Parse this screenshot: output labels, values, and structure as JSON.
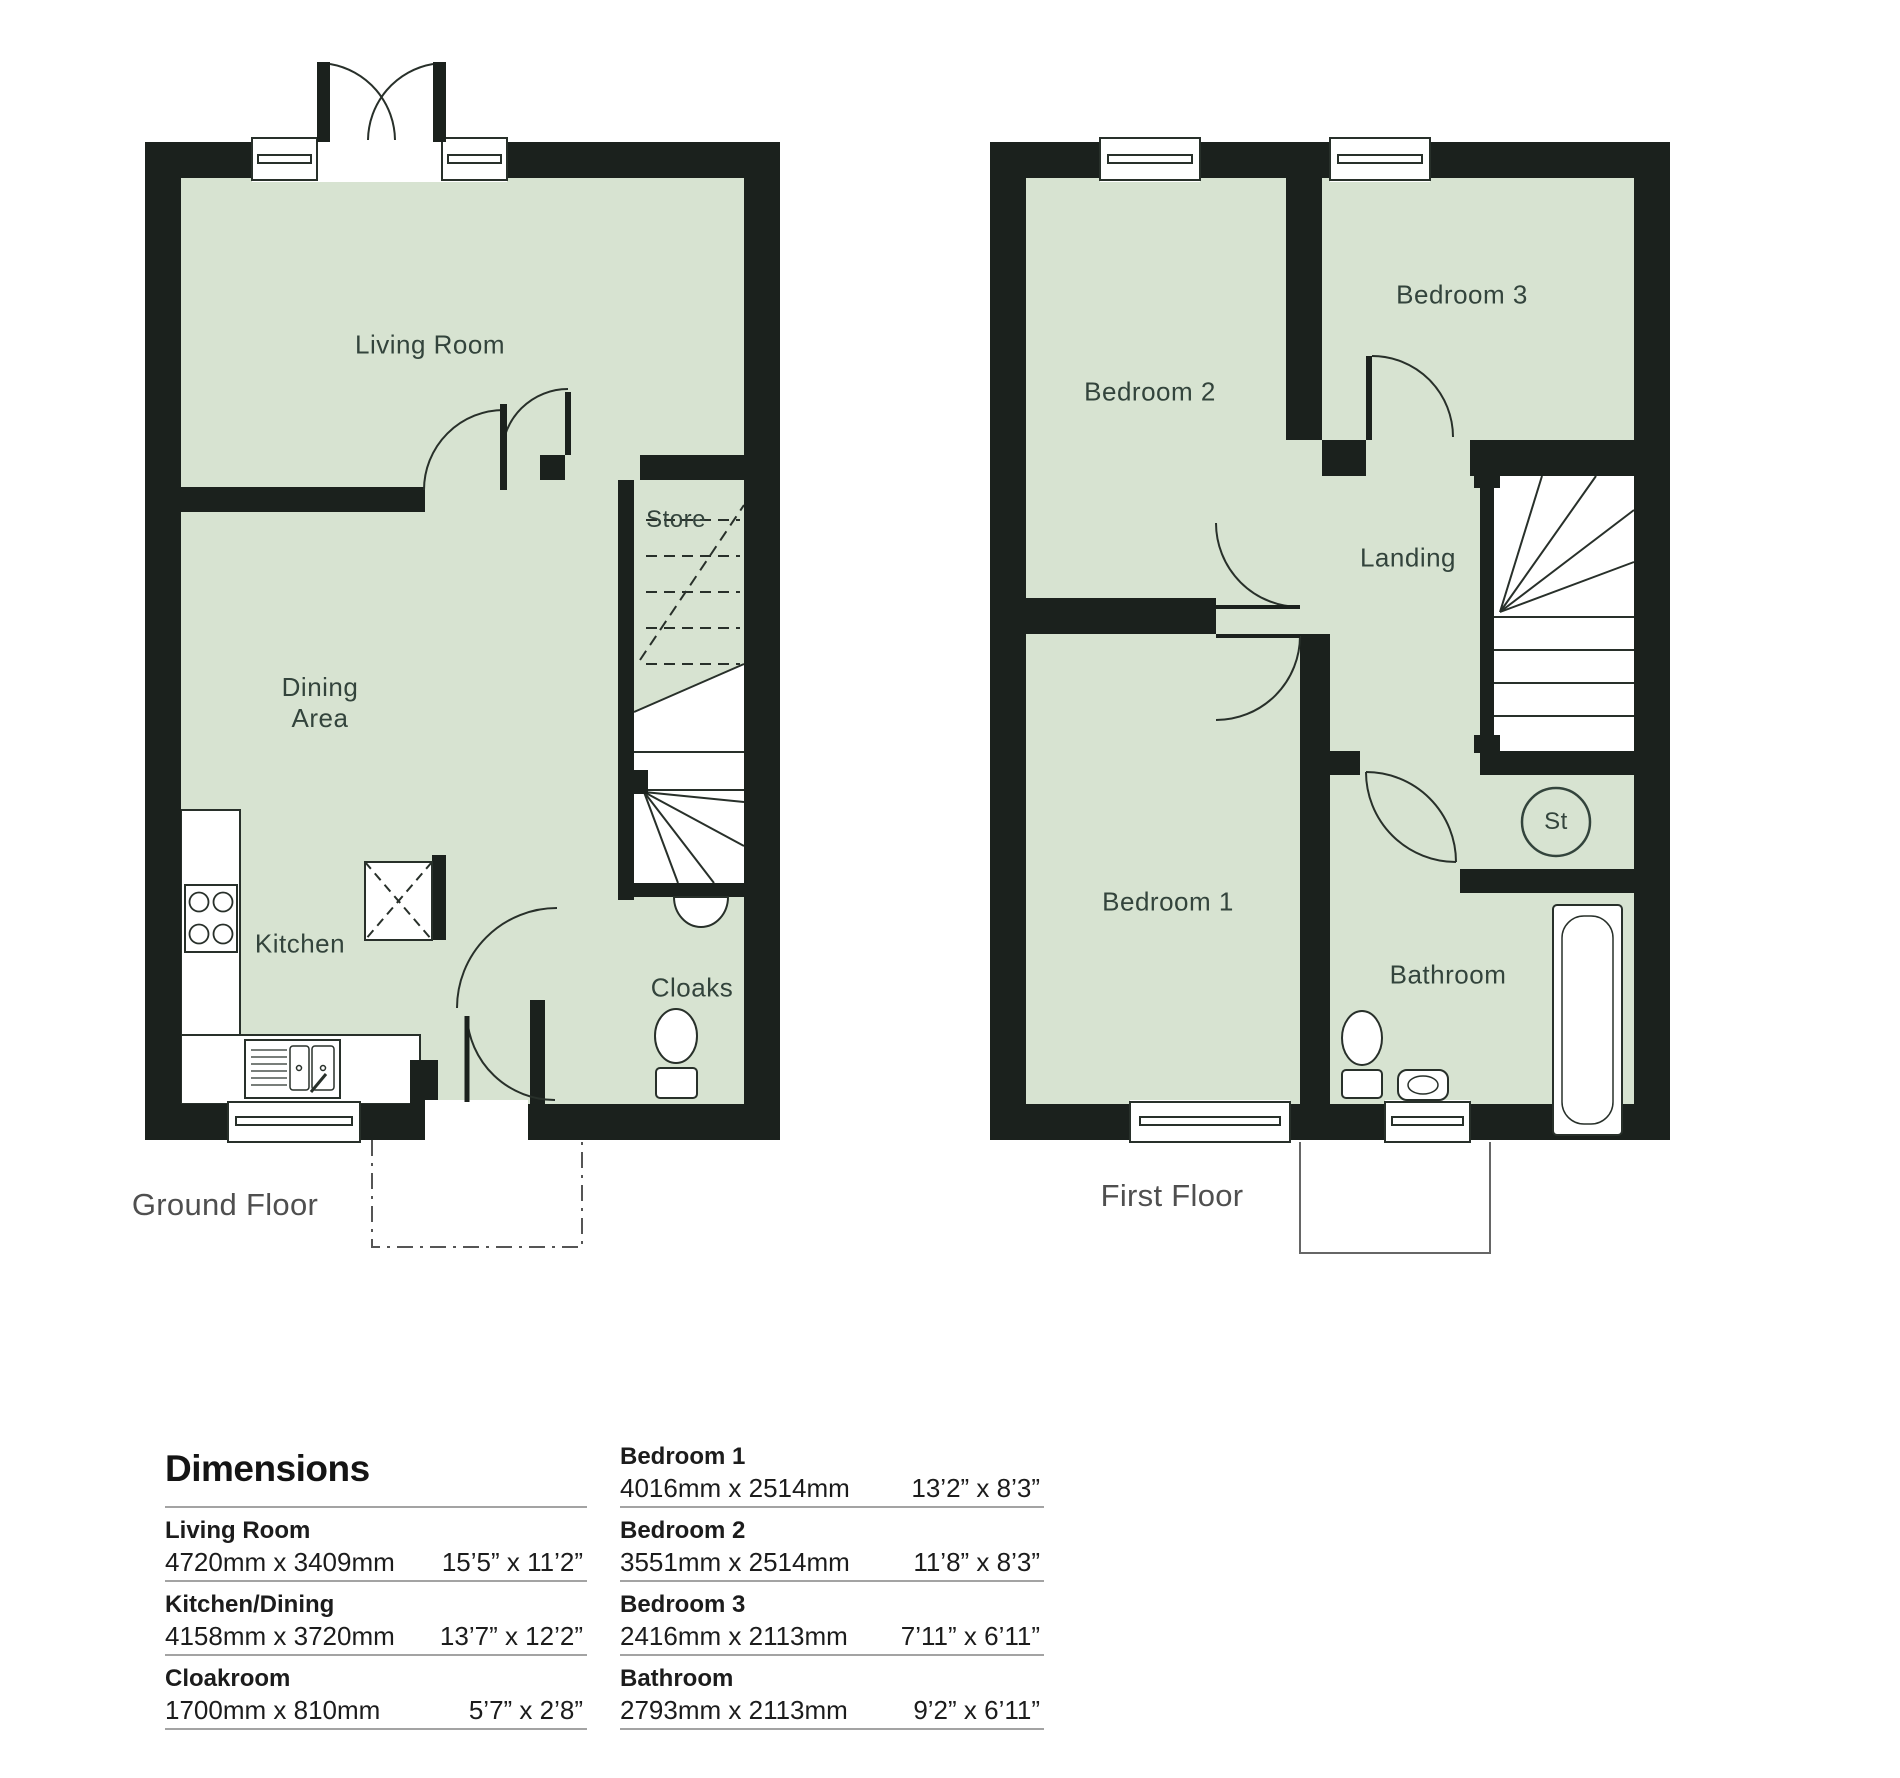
{
  "floors": {
    "ground": {
      "title": "Ground Floor",
      "rooms": {
        "living": "Living Room",
        "dining_line1": "Dining",
        "dining_line2": "Area",
        "kitchen": "Kitchen",
        "store": "Store",
        "cloaks": "Cloaks"
      }
    },
    "first": {
      "title": "First Floor",
      "rooms": {
        "bedroom2": "Bedroom 2",
        "bedroom3": "Bedroom 3",
        "landing": "Landing",
        "bedroom1": "Bedroom 1",
        "bathroom": "Bathroom",
        "store_circle": "St"
      }
    }
  },
  "dimensions": {
    "title": "Dimensions",
    "left": [
      {
        "name": "Living Room",
        "metric": "4720mm x 3409mm",
        "imperial": "15’5” x 11’2”"
      },
      {
        "name": "Kitchen/Dining",
        "metric": "4158mm x 3720mm",
        "imperial": "13’7” x 12’2”"
      },
      {
        "name": "Cloakroom",
        "metric": "1700mm x 810mm",
        "imperial": "5’7” x 2’8”"
      }
    ],
    "right": [
      {
        "name": "Bedroom 1",
        "metric": "4016mm x 2514mm",
        "imperial": "13’2” x 8’3”"
      },
      {
        "name": "Bedroom 2",
        "metric": "3551mm x 2514mm",
        "imperial": "11’8” x 8’3”"
      },
      {
        "name": "Bedroom 3",
        "metric": "2416mm x 2113mm",
        "imperial": "7’11” x 6’11”"
      },
      {
        "name": "Bathroom",
        "metric": "2793mm x 2113mm",
        "imperial": "9’2” x 6’11”"
      }
    ]
  },
  "colors": {
    "room_fill": "#d7e3d1",
    "wall": "#1b211d",
    "line": "#28302a",
    "label": "#33443c"
  }
}
